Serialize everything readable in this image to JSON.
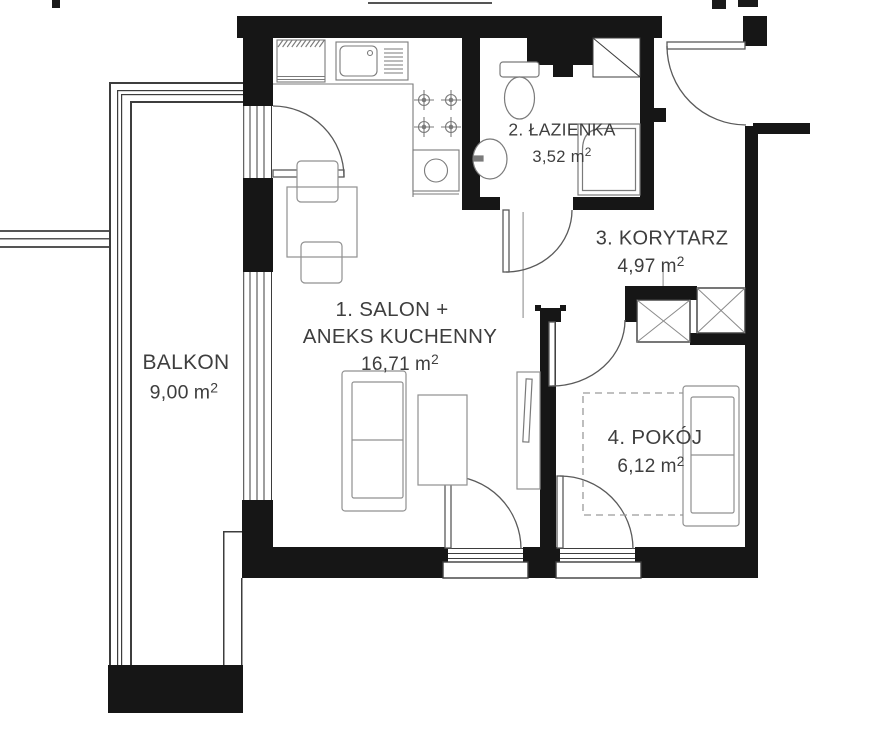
{
  "rooms": [
    {
      "key": "balkon",
      "label": "BALKON",
      "area_value": "9,00",
      "area_unit": "m",
      "area_sup": "2"
    },
    {
      "key": "salon",
      "label": "1. SALON +",
      "label2": "ANEKS KUCHENNY",
      "area_value": "16,71",
      "area_unit": "m",
      "area_sup": "2"
    },
    {
      "key": "lazienka",
      "label": "2. ŁAZIENKA",
      "area_value": "3,52",
      "area_unit": "m",
      "area_sup": "2"
    },
    {
      "key": "korytarz",
      "label": "3. KORYTARZ",
      "area_value": "4,97",
      "area_unit": "m",
      "area_sup": "2"
    },
    {
      "key": "pokoj",
      "label": "4. POKÓJ",
      "area_value": "6,12",
      "area_unit": "m",
      "area_sup": "2"
    }
  ],
  "elements": [
    "exterior-wall",
    "interior-wall",
    "entrance-door",
    "bathroom-door",
    "room-door",
    "balcony-door",
    "window",
    "window-sill",
    "balcony-railing",
    "ventilation-shaft",
    "duct-shaft",
    "fridge",
    "kitchen-sink",
    "stove-burners",
    "oven",
    "dining-table",
    "chair",
    "sofa",
    "coffee-table",
    "tv-cabinet",
    "toilet",
    "washbasin",
    "shower",
    "bed",
    "couch"
  ],
  "colors": {
    "background": "#ffffff",
    "wall": "#161616",
    "outline": "#3d3d3d",
    "door_arc": "#5a5a5a",
    "furniture": "#909090",
    "fixture": "#7a7a7a",
    "text": "#3e3e3e"
  }
}
